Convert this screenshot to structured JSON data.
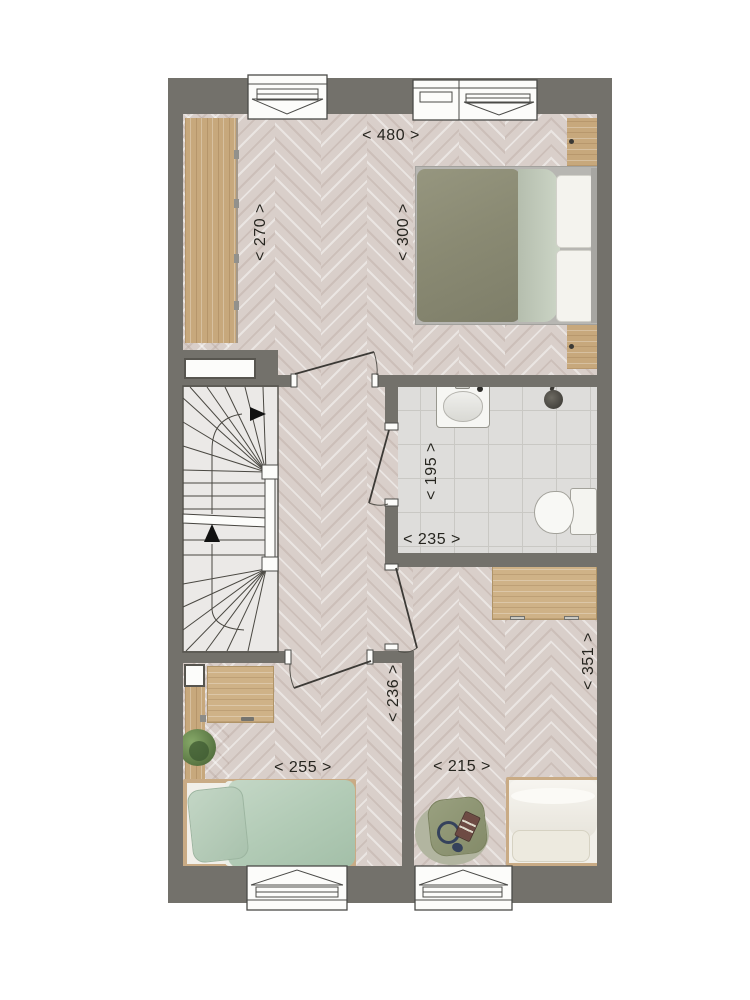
{
  "plan": {
    "kind": "floor-plan-upper-storey",
    "dimension_labels": [
      {
        "id": "bedroom-top-width",
        "text": "< 480 >",
        "orientation": "horizontal"
      },
      {
        "id": "bedroom-top-left-depth",
        "text": "< 270 >",
        "orientation": "vertical"
      },
      {
        "id": "bedroom-top-bed-depth",
        "text": "< 300 >",
        "orientation": "vertical"
      },
      {
        "id": "bathroom-depth",
        "text": "< 195 >",
        "orientation": "vertical"
      },
      {
        "id": "bathroom-width",
        "text": "< 235 >",
        "orientation": "horizontal"
      },
      {
        "id": "hall-bedroom-right-depth",
        "text": "< 236 >",
        "orientation": "vertical"
      },
      {
        "id": "bedroom-left-width",
        "text": "< 255 >",
        "orientation": "horizontal"
      },
      {
        "id": "bedroom-right-width",
        "text": "< 215 >",
        "orientation": "horizontal"
      },
      {
        "id": "bedroom-right-depth",
        "text": "< 351 >",
        "orientation": "vertical"
      }
    ],
    "colors": {
      "wall": "#73716b",
      "floor": "#d9cfca",
      "bathroom_tile": "#dedddb",
      "wood": "#c7a87c",
      "duvet_olive": "#8b8b75",
      "duvet_sage": "#b6cdb9",
      "bedding_white": "#f3f1ec",
      "armchair_olive": "#8e9476",
      "plant_green": "#5d7a4a"
    }
  }
}
